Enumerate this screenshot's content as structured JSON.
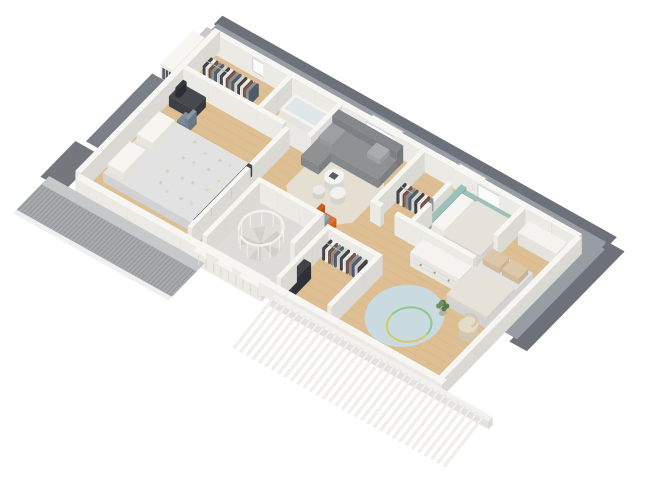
{
  "canvas": {
    "width": 660,
    "height": 495,
    "background": "#ffffff"
  },
  "scene": {
    "type": "3d-floor-plan-render",
    "view": "isometric-top-down",
    "floor_label": "attic-level",
    "rooms": [
      {
        "name": "master-bedroom",
        "furniture": [
          "double-bed",
          "pillows",
          "quilt",
          "desk",
          "monitor",
          "desk-chair"
        ]
      },
      {
        "name": "dressing-room",
        "furniture": [
          "clothes-rail"
        ]
      },
      {
        "name": "bathroom",
        "furniture": [
          "bathtub"
        ]
      },
      {
        "name": "living-landing",
        "furniture": [
          "corner-sofa",
          "coffee-table",
          "poufs",
          "area-rug",
          "orange-lounge-chair",
          "throw-blanket"
        ]
      },
      {
        "name": "stair-room",
        "furniture": [
          "spiral-staircase"
        ]
      },
      {
        "name": "bedroom-2",
        "furniture": [
          "bed-teal-headboard",
          "walk-in-closet",
          "clothes-rail",
          "sideboard"
        ]
      },
      {
        "name": "kids-bedroom",
        "furniture": [
          "bed",
          "dresser",
          "round-rug",
          "hula-hoop",
          "armchair",
          "plant"
        ]
      },
      {
        "name": "closet",
        "furniture": [
          "clothes-rail",
          "shelf-unit"
        ]
      }
    ],
    "exterior_features": [
      "roof-eave-band",
      "roof-slope",
      "skylights",
      "dormer",
      "chimney",
      "hatched-roof-slope",
      "exposed-rafters"
    ]
  },
  "colors": {
    "background": "#ffffff",
    "roofFascia": "#6d727a",
    "roofSlope": "#989da4",
    "roofSlopeLight": "#c6c8c9",
    "roofHatchBase": "#a7aaac",
    "roofHatchLine": "#8f9295",
    "roofDark": "#74787e",
    "gableEave": "#7b8087",
    "chimneyTop": "#c5c7c9",
    "wood": "#ddbf93",
    "woodLine": "#d2b285",
    "bathFloor": "#eae8e4",
    "stairFloor": "#dedcd8",
    "wallTop": "#f7f6f3",
    "wallFaceL": "#eceae5",
    "wallFaceD": "#dbd9d3",
    "rugBeige": "#e5dfd1",
    "rugBlue": "#c9dbe0",
    "hoopYellow": "#d2cc66",
    "hoopGreen": "#92c78e",
    "sofa": "#8f9193",
    "sofaBack": "#84878b",
    "sofaCushion": "#9da0a3",
    "sofaPillow": "#aaadaf",
    "orange": "#e2702a",
    "orangeDark": "#c95d1f",
    "throwGray": "#9aa0a3",
    "teal": "#9ec0ba",
    "bedTop": "#e3e2e3",
    "bedSide": "#d2d1d3",
    "duvet": "#e6e2da",
    "pillowWhite": "#f7f5f1",
    "pillowBeige": "#dcc8a8",
    "footboard": "#46494e",
    "deskDark": "#46494e",
    "monitor": "#33363a",
    "chairBlue": "#7e8d99",
    "clothes": [
      "#3a3d42",
      "#f1f0ee",
      "#6e4f41",
      "#8d9094",
      "#4e5a66",
      "#d9d6d0"
    ],
    "railGray": "#b9b6b0",
    "dresser": "#f4f3f0",
    "knob": "#9a978f",
    "armchairTop": "#e6dcc8",
    "armchairSide": "#d3c7ae",
    "plantGreen": "#6f8f5f",
    "plantDark": "#5a7a4c",
    "pot": "#b5b0a8",
    "stairTread": "#deddd8",
    "stairTread2": "#d3d0ca",
    "stairRail": "#f2f1ee",
    "stairPole": "#c7c4be",
    "windowGlass": "#fafbfb",
    "windowFrame": "#cfd2d4",
    "skylight": "#fdfdfd",
    "skylightFrame": "#b8bcc0",
    "pictureFill": "#f4f3f0",
    "pictureFrame": "#5b5e63",
    "shelfDark": "#3f4246",
    "rafter": "#f3f2ef",
    "rafterEdge": "#d8d6d1",
    "quiltDots": [
      "#cdd6b0",
      "#e3cdc9",
      "#c6cfd9",
      "#e0d7b8"
    ]
  }
}
